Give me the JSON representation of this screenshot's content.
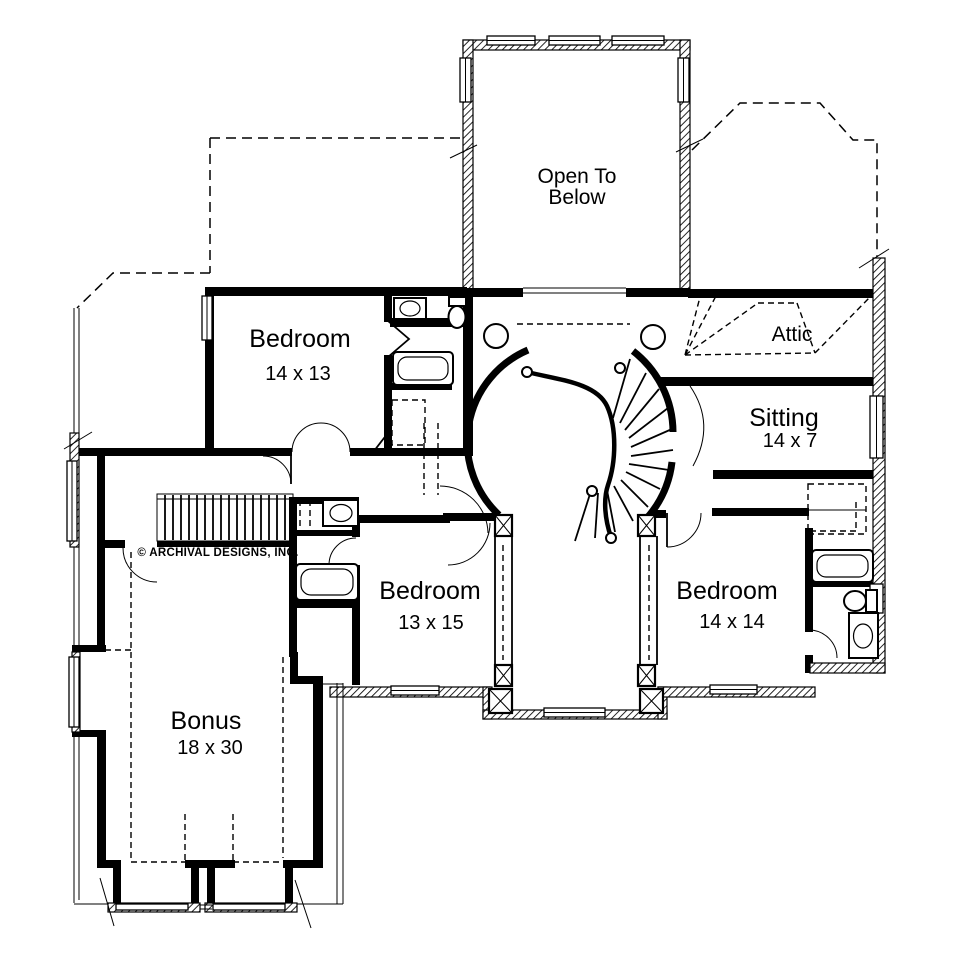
{
  "plan": {
    "copyright": "© ARCHIVAL DESIGNS, INC.",
    "rooms": {
      "open_to_below": {
        "line1": "Open To",
        "line2": "Below"
      },
      "bedroom_upper": {
        "name": "Bedroom",
        "dims": "14 x 13"
      },
      "attic": {
        "name": "Attic"
      },
      "sitting": {
        "name": "Sitting",
        "dims": "14 x 7"
      },
      "bedroom_middle": {
        "name": "Bedroom",
        "dims": "13 x 15"
      },
      "bedroom_right": {
        "name": "Bedroom",
        "dims": "14 x 14"
      },
      "bonus": {
        "name": "Bonus",
        "dims": "18 x 30"
      }
    },
    "colors": {
      "ink": "#000000",
      "paper": "#ffffff"
    }
  }
}
